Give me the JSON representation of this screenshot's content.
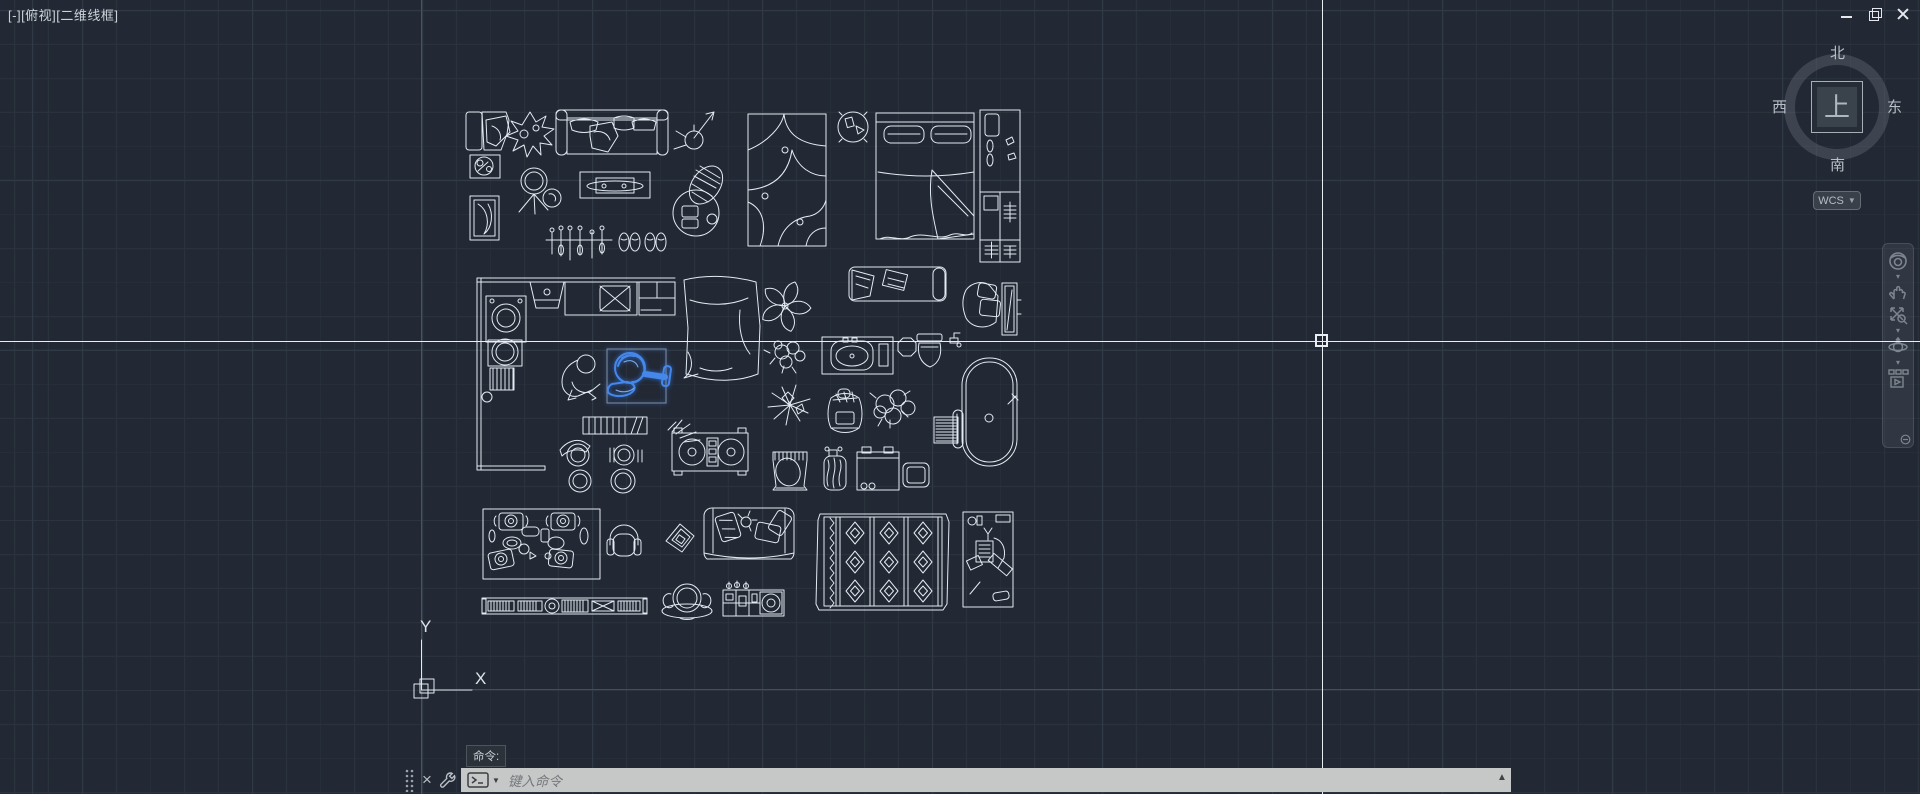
{
  "viewport": {
    "segments": [
      "[-]",
      "[俯视]",
      "[二维线框]"
    ]
  },
  "window_controls": {
    "buttons": [
      "minimize",
      "restore",
      "close"
    ]
  },
  "viewcube": {
    "north": "北",
    "west": "西",
    "east": "东",
    "south": "南",
    "top_face": "上",
    "wcs_label": "WCS"
  },
  "navbar": {
    "tools": [
      "full-navigation-wheel",
      "wheel-menu",
      "pan",
      "zoom-extents",
      "zoom-menu",
      "orbit",
      "orbit-menu",
      "showmotion",
      "collapse"
    ]
  },
  "command": {
    "tooltip": "命令:",
    "placeholder": "键入命令"
  },
  "ucs": {
    "x_label": "X",
    "y_label": "Y"
  },
  "canvas": {
    "selected_block": {
      "name": "watering-can-sketch",
      "highlight_color": "#4687ea"
    },
    "blocks": [
      "armchair-with-throw",
      "plant-sketch",
      "three-seat-sofa",
      "floor-lamp",
      "framed-art",
      "tripod-stool",
      "coffee-table",
      "wicker-chair",
      "door-panel-art",
      "coat-rack",
      "slippers",
      "abstract-rug",
      "round-side-table",
      "double-bed",
      "tall-wardrobe",
      "kitchen-plan",
      "person-figure",
      "watering-can-sketch",
      "bookshelf-row",
      "stool-with-scarf",
      "bar-stool",
      "stool-pair",
      "quilt",
      "dj-turntables",
      "five-petal-plant",
      "daybed-bench",
      "lounge-chair-with-mirror",
      "small-leafy-plant",
      "sink-vanity",
      "octagon-stool",
      "toilet",
      "faucet",
      "spiky-plant",
      "backpack",
      "large-leafy-plant",
      "vent-grill",
      "oval-bathtub",
      "striped-bag",
      "jar-basket",
      "washer-box",
      "small-box",
      "meeting-table-set",
      "headphones",
      "diamond-book",
      "two-seat-sofa",
      "piano-keyboard",
      "coffee-cup",
      "mixer-console",
      "kilim-rug",
      "bathroom-plan"
    ]
  },
  "colors": {
    "background": "#222834",
    "grid_minor": "#2a323d",
    "grid_major": "#303a46",
    "line": "#e3eaf1",
    "axis_x_red": "#8a3232",
    "axis_y_green": "#2e6b2e",
    "crosshair": "#e9eef3",
    "command_bar_bg": "#c6c8c8"
  }
}
